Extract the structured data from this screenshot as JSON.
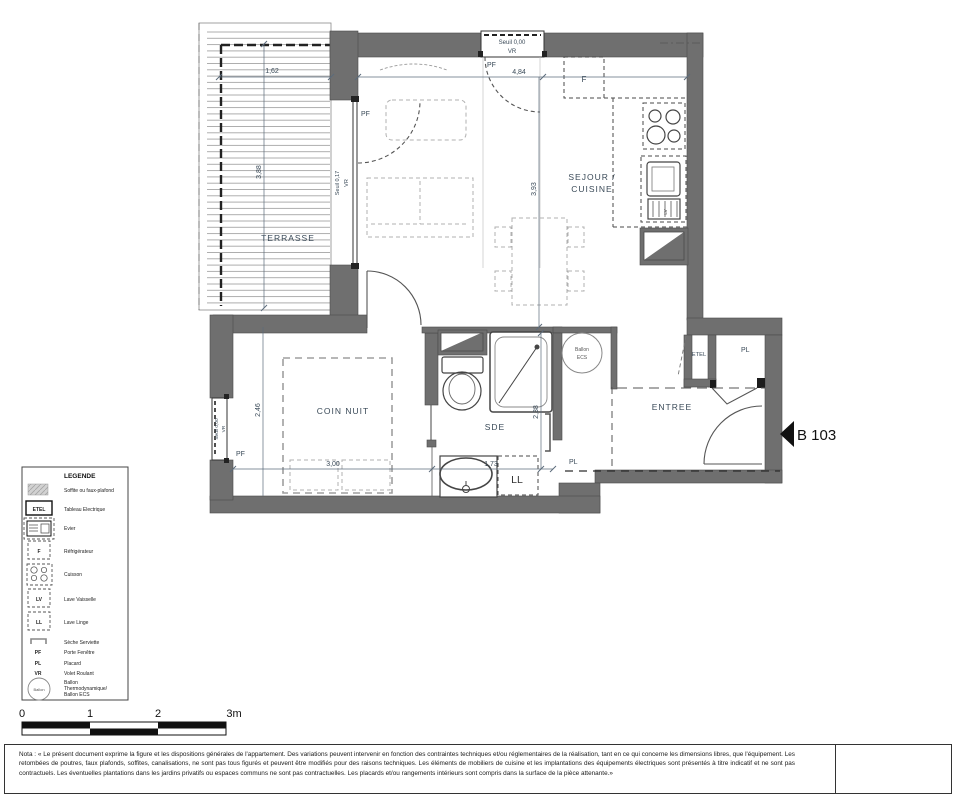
{
  "unit": {
    "id": "B 103"
  },
  "rooms": {
    "terrasse": "TERRASSE",
    "sejour": [
      "SEJOUR /",
      "CUISINE"
    ],
    "coin_nuit": "COIN NUIT",
    "sde": "SDE",
    "entree": "ENTREE"
  },
  "dims": {
    "terrasse_w": "1,62",
    "terrasse_h": "3,88",
    "sejour_w": "4,84",
    "sejour_h": "3,93",
    "coin_w": "3,00",
    "coin_h": "2,46",
    "sde_w": "1,73",
    "sde_h": "2,38"
  },
  "openings": {
    "seuil_000": "Seuil 0,00",
    "seuil_017": "Seuil 0,17",
    "vr": "VR",
    "pf": "PF"
  },
  "labels": {
    "f": "F",
    "lv": "LV",
    "ll": "LL",
    "pl": "PL",
    "etel": "ETEL",
    "ballon_l1": "Ballon",
    "ballon_l2": "ECS"
  },
  "legend": {
    "title": "LEGENDE",
    "items": [
      {
        "label": "Soffite ou faux-plafond"
      },
      {
        "tag": "ETEL",
        "label": "Tableau Electrique"
      },
      {
        "label": "Evier"
      },
      {
        "tag": "F",
        "label": "Réfrigérateur"
      },
      {
        "label": "Cuisson"
      },
      {
        "tag": "LV",
        "label": "Lave Vaisselle"
      },
      {
        "tag": "LL",
        "label": "Lave Linge"
      },
      {
        "label": "Sèche Serviette"
      },
      {
        "tag": "PF",
        "label": "Porte Fenêtre"
      },
      {
        "tag": "PL",
        "label": "Placard"
      },
      {
        "tag": "VR",
        "label": "Volet Roulant"
      },
      {
        "tag": "Ballon",
        "lines": [
          "Ballon",
          "Thermodynamique/",
          "Ballon ECS"
        ]
      }
    ]
  },
  "scalebar": {
    "ticks": [
      "0",
      "1",
      "2",
      "3m"
    ]
  },
  "nota": "Nota : « Le présent document exprime la figure et les dispositions générales de l'appartement. Des variations peuvent intervenir en fonction des contraintes techniques et/ou réglementaires de la réalisation, tant en ce qui concerne les dimensions libres, que l'équipement. Les retombées de poutres, faux plafonds, soffites, canalisations, ne sont pas tous figurés et peuvent être modifiés pour des raisons techniques. Les éléments de mobiliers de cuisine et les implantations des équipements électriques sont présentés à titre indicatif et ne sont pas contractuels. Les éventuelles plantations dans les jardins privatifs ou espaces communs ne sont pas contractuelles. Les placards et/ou rangements intérieurs sont compris dans la surface de la pièce attenante.»",
  "colors": {
    "wall": "#6f6f6f",
    "label_text": "#3a4a58",
    "accent_black": "#111111"
  }
}
